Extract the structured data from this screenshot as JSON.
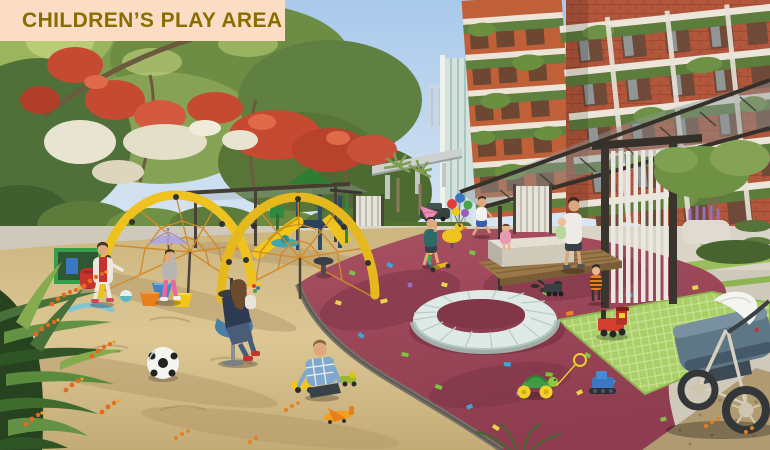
{
  "banner": {
    "label": "CHILDREN’S PLAY AREA"
  },
  "palette": {
    "banner-bg": "#fbdcc5",
    "banner-text": "#8a6d00",
    "sky-top": "#a9c9ec",
    "sky-horizon": "#e3eef8",
    "foliage-dark": "#3f5f2e",
    "foliage-mid": "#6f8f45",
    "foliage-light": "#a9c162",
    "flower-red": "#c64a32",
    "blossom-white": "#e9e4d2",
    "brick": "#b2573b",
    "brick-warm": "#c06038",
    "slab-white": "#ece6da",
    "sand": "#d5c08c",
    "sand-shadow": "#b49a6b",
    "rubber-maroon": "#9c4458",
    "rubber-shadow": "#7c3647",
    "concrete": "#cfc9bb",
    "mat-green": "#aacf68",
    "gravel-brown": "#b09a72",
    "equip-yellow": "#eec21f",
    "net-orange": "#d08a28",
    "ring-blue": "#dfe9e6",
    "umbrella-purple": "#b3a8dc",
    "kite-pink": "#f08cb4",
    "chair-blue": "#4a7fa5",
    "stroller-slate": "#5e7787",
    "confetti": [
      "#7dc242",
      "#e8d44d",
      "#3aa8d8",
      "#e86aa0",
      "#9a6fd0",
      "#f2832e"
    ]
  },
  "scene": {
    "elements": [
      "red-flowering-trees",
      "white-blossom-trees",
      "apartment-tower-green-balconies",
      "glass-tower",
      "elevated-road",
      "pergola-glass-canopy",
      "white-slat-screen",
      "arch-rope-climber",
      "slide-structure",
      "spinner-ring-seat",
      "duck-spring-rider",
      "merry-go-round-dish",
      "maroon-safety-surface-confetti",
      "sand-pit",
      "soccer-ball",
      "kids-stools",
      "toy-trucks",
      "toy-plane",
      "toy-train",
      "toy-turtle",
      "toy-bulldozer",
      "stone-bench",
      "wood-deck",
      "baby-stroller",
      "girl-with-red-vest",
      "girl-with-umbrella",
      "woman-with-baby-on-chair",
      "boy-in-plaid-shirt",
      "kid-with-kite",
      "runner-boy",
      "adult-carrying-child",
      "striped-toddler",
      "lavender-planter",
      "frangipani-tree",
      "green-grid-mat",
      "tropical-foreground-plants",
      "orange-flower-spikes"
    ]
  }
}
